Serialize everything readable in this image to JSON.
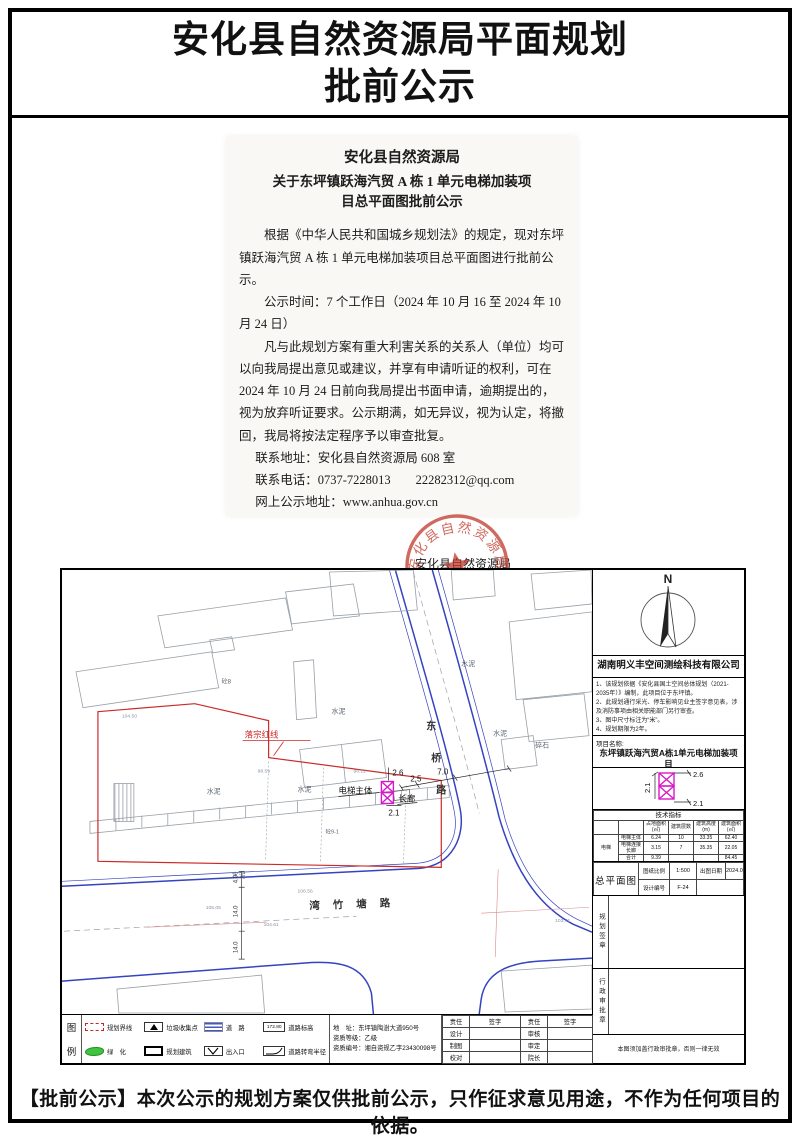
{
  "page": {
    "title_line1": "安化县自然资源局平面规划",
    "title_line2": "批前公示",
    "footer_notice": "【批前公示】本次公示的规划方案仅供批前公示，只作征求意见用途，不作为任何项目的依据。"
  },
  "letter": {
    "org": "安化县自然资源局",
    "subject_line1": "关于东坪镇跃海汽贸 A 栋 1 单元电梯加装项",
    "subject_line2": "目总平面图批前公示",
    "para1": "根据《中华人民共和国城乡规划法》的规定，现对东坪镇跃海汽贸 A 栋 1 单元电梯加装项目总平面图进行批前公示。",
    "para2": "公示时间：7 个工作日（2024 年 10 月 16 至 2024 年 10 月 24 日）",
    "para3": "凡与此规划方案有重大利害关系的关系人（单位）均可以向我局提出意见或建议，并享有申请听证的权利，可在 2024 年 10 月 24 日前向我局提出书面申请，逾期提出的，视为放弃听证要求。公示期满，如无异议，视为认定，将撤回，我局将按法定程序予以审查批复。",
    "contact_address": "联系地址：安化县自然资源局 608 室",
    "contact_phone": "联系电话：0737-7228013　　22282312@qq.com",
    "contact_web": "网上公示地址：www.anhua.gov.cn",
    "signer": "安化县自然资源局",
    "date": "2024 年 10 月 15 日",
    "seal_text": "安化县自然资源局"
  },
  "plan": {
    "north": "N",
    "company": "湖南明义丰空间测绘科技有限公司",
    "notes": [
      "1、该规划依据《安化县国土空间总体规划（2021-2035年）》编制，此项目位于东坪镇。",
      "2、此规划通行采光、停车影响见业主签字意见表，涉及消防事项由相关职能部门另行审查。",
      "3、图中尺寸标注为“米”。",
      "4、规划期限为2年。"
    ],
    "project_label": "项目名称:",
    "project_line1": "东坪镇跃海汽贸A栋1单元电梯加装项目",
    "project_line2": "总平面图",
    "detail": {
      "top": "2.6",
      "bottom": "2.1",
      "left": "2.1"
    },
    "tech": {
      "title": "技术指标",
      "h_area": "占地面积(㎡)",
      "h_floors": "建筑层数",
      "h_height": "建筑高度(m)",
      "h_barea": "建筑面积(㎡)",
      "group": "电梯",
      "r1": {
        "name": "电梯主体",
        "a": "6.24",
        "f": "10",
        "h": "33.35",
        "b": "62.40"
      },
      "r2": {
        "name": "电梯连接长廊",
        "a": "3.15",
        "f": "7",
        "h": "35.35",
        "b": "22.05"
      },
      "r3": {
        "name": "合计",
        "a": "9.39",
        "f": "",
        "h": "",
        "b": "84.45"
      }
    },
    "titleblock": {
      "name": "总平面图",
      "scale_l": "图纸比例",
      "scale_v": "1:500",
      "date_l": "出图日期",
      "date_v": "2024.09",
      "code_l": "设计编号",
      "code_v": "F-24"
    },
    "stamps": {
      "s1": "规划签章",
      "s2": "行政审批章",
      "note": "本图须加盖行政审批章，否则一律无效"
    },
    "drawing": {
      "road_ne1": "东",
      "road_ne2": "桥",
      "road_ne3": "路",
      "road_s": "湾竹塘路",
      "red_label": "落宗红线",
      "elevator": "电梯主体",
      "corridor": "长廊",
      "dim_26": "2.6",
      "dim_21": "2.1",
      "dim_25": "2.5",
      "dim_70": "7.0",
      "cement": "水泥",
      "gravel": "碎石",
      "conc1": "砼8",
      "conc2": "砼9-1",
      "elev1": "104.50",
      "elev2": "98.59",
      "elev3": "98.12",
      "elev4": "106.56",
      "elev5": "105.05",
      "elev6": "104.61",
      "elev7": "103.71",
      "rdim1": "4.0",
      "rdim2": "14.0",
      "rdim3": "14.0"
    },
    "legend": {
      "fig1": "图",
      "fig2": "例",
      "item_boundary": "规划界线",
      "item_trash": "垃圾收集点",
      "item_road": "道　路",
      "item_road_elev": "道路标高",
      "road_elev_value": "172.80",
      "item_green": "绿　化",
      "item_building": "规划建筑",
      "item_entrance": "出入口",
      "item_radius": "道路转弯半径",
      "address": "地　址：东坪镇陶澍大道950号",
      "cert_level": "资质等级：乙级",
      "cert_no": "资质编号：湘自资规乙字23430098号"
    },
    "sig": {
      "c1": "责任",
      "c2": "签字",
      "c3": "责任",
      "c4": "签字",
      "r1a": "设计",
      "r1b": "审核",
      "r2a": "制图",
      "r2b": "审定",
      "r3a": "校对",
      "r3b": "院长"
    }
  }
}
